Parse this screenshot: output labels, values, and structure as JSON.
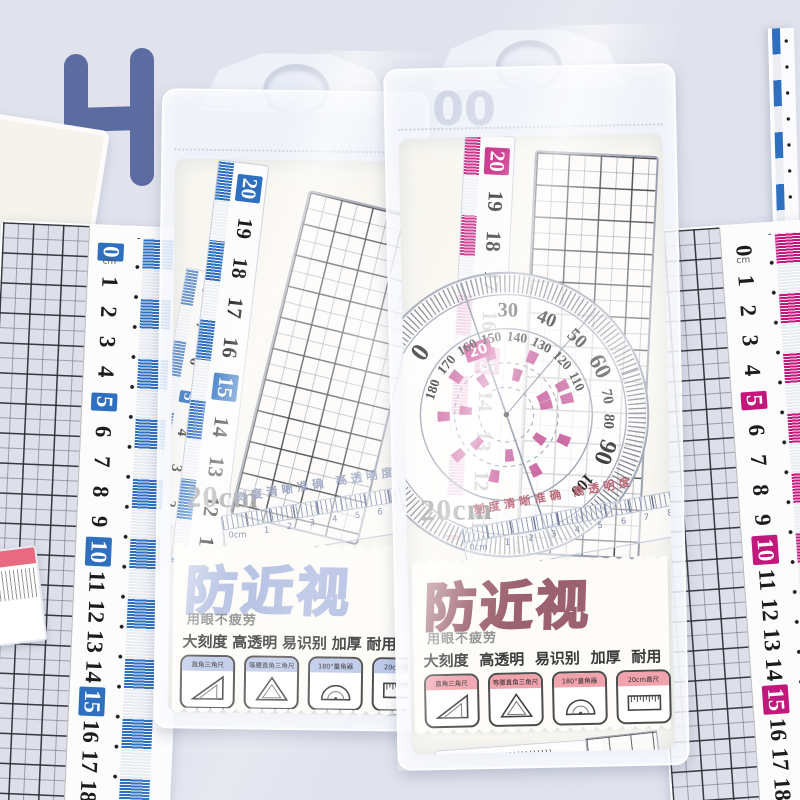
{
  "backdrop": {
    "letter": "H",
    "partial_digits": "00",
    "bg_color": "#e0e3ed",
    "shape_color": "#5d6ca0",
    "ring_color": "#2c3e68",
    "star_color": "#dcc9a4"
  },
  "left_ruler": {
    "unit": "cm",
    "numbers": [
      "0",
      "1",
      "2",
      "3",
      "4",
      "5",
      "6",
      "7",
      "8",
      "9",
      "10",
      "11",
      "12",
      "13",
      "14",
      "15",
      "16",
      "17",
      "18"
    ],
    "highlighted": [
      "0",
      "5",
      "10",
      "15"
    ],
    "accent": "#2e6fc0"
  },
  "right_ruler": {
    "unit": "cm",
    "numbers": [
      "0",
      "1",
      "2",
      "3",
      "4",
      "5",
      "6",
      "7",
      "8",
      "9",
      "10",
      "11",
      "12",
      "13",
      "14",
      "15",
      "16",
      "17",
      "18"
    ],
    "highlighted": [
      "5",
      "10",
      "15"
    ],
    "accent": "#c2187c"
  },
  "package_left": {
    "size_label": "20cm",
    "tagline": "刻度清晰准确  高透明度",
    "brand": "防近视",
    "slogan": "用眼不疲劳",
    "features": [
      "大刻度",
      "高透明",
      "易识别",
      "加厚",
      "耐用"
    ],
    "items": [
      {
        "label": "直角三角尺"
      },
      {
        "label": "等腰直角三角尺"
      },
      {
        "label": "180°量角器"
      },
      {
        "label": "20cm直尺"
      }
    ],
    "ruler_numbers": [
      "20",
      "19",
      "18",
      "17",
      "16",
      "15",
      "14",
      "13",
      "12",
      "11"
    ],
    "ruler_highlighted": [
      "20",
      "15"
    ],
    "second_scale_numbers": [
      "8",
      "7",
      "6",
      "5",
      "4",
      "3",
      "2"
    ],
    "mini_ruler_labels": [
      "0cm",
      "1",
      "2",
      "3",
      "4",
      "5",
      "6",
      "7",
      "8",
      "9"
    ],
    "protractor_edge_marks": "170 180",
    "zero_label": "0",
    "unit": "cm",
    "accent": "#2e6fc0",
    "brand_outline": "#b2bee2",
    "item_label_bg": "#bdc9ea"
  },
  "package_right": {
    "size_label": "20cm",
    "tagline": "刻度清晰准确  高透明度",
    "brand": "防近视",
    "slogan": "用眼不疲劳",
    "features": [
      "大刻度",
      "高透明",
      "易识别",
      "加厚",
      "耐用"
    ],
    "items": [
      {
        "label": "直角三角尺"
      },
      {
        "label": "等腰直角三角尺"
      },
      {
        "label": "180°量角器"
      },
      {
        "label": "20cm直尺"
      }
    ],
    "ruler_numbers": [
      "20",
      "19",
      "18",
      "17",
      "16",
      "15",
      "14",
      "13",
      "12",
      "11"
    ],
    "ruler_highlighted": [
      "20",
      "15"
    ],
    "mini_ruler_labels": [
      "0cm",
      "1",
      "2",
      "3",
      "4",
      "5",
      "6",
      "7",
      "8",
      "9"
    ],
    "zero_label": "0",
    "unit": "cm",
    "accent": "#c2187c",
    "brand_outline": "#9c616e",
    "item_label_bg": "#f0a3ad",
    "protractor": {
      "outer_numbers": [
        "0",
        "30",
        "40",
        "50",
        "60",
        "70",
        "80",
        "90",
        "100"
      ],
      "inner_numbers": [
        "180",
        "170",
        "160",
        "150",
        "140",
        "130",
        "120",
        "110"
      ],
      "box_label": "20"
    }
  }
}
